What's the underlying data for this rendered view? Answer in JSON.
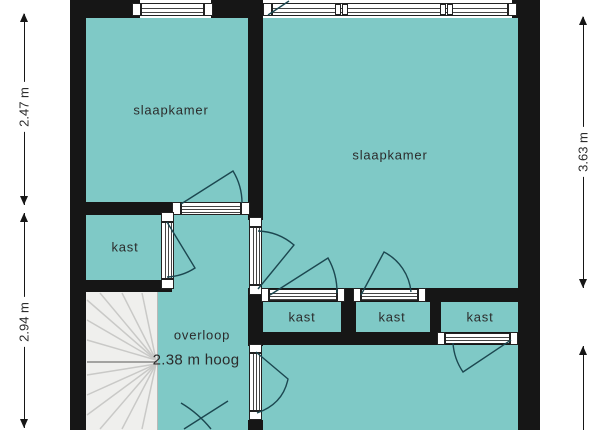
{
  "plan": {
    "rooms": {
      "bedroom_left": {
        "label": "slaapkamer"
      },
      "bedroom_right": {
        "label": "slaapkamer"
      },
      "closet_left": {
        "label": "kast"
      },
      "closet_a": {
        "label": "kast"
      },
      "closet_b": {
        "label": "kast"
      },
      "closet_c": {
        "label": "kast"
      },
      "landing": {
        "label": "overloop",
        "note": "2.38 m hoog"
      }
    },
    "dimensions": {
      "left_upper": "2.47 m",
      "left_lower": "2.94 m",
      "right_upper": "3.63 m"
    },
    "colors": {
      "room_fill": "#7FC9C6",
      "wall": "#161616",
      "stairs_fill": "#EFEFED",
      "stairs_line": "#C9C9C7",
      "swing_line": "#1C4750",
      "text": "#2B2B2B"
    }
  }
}
